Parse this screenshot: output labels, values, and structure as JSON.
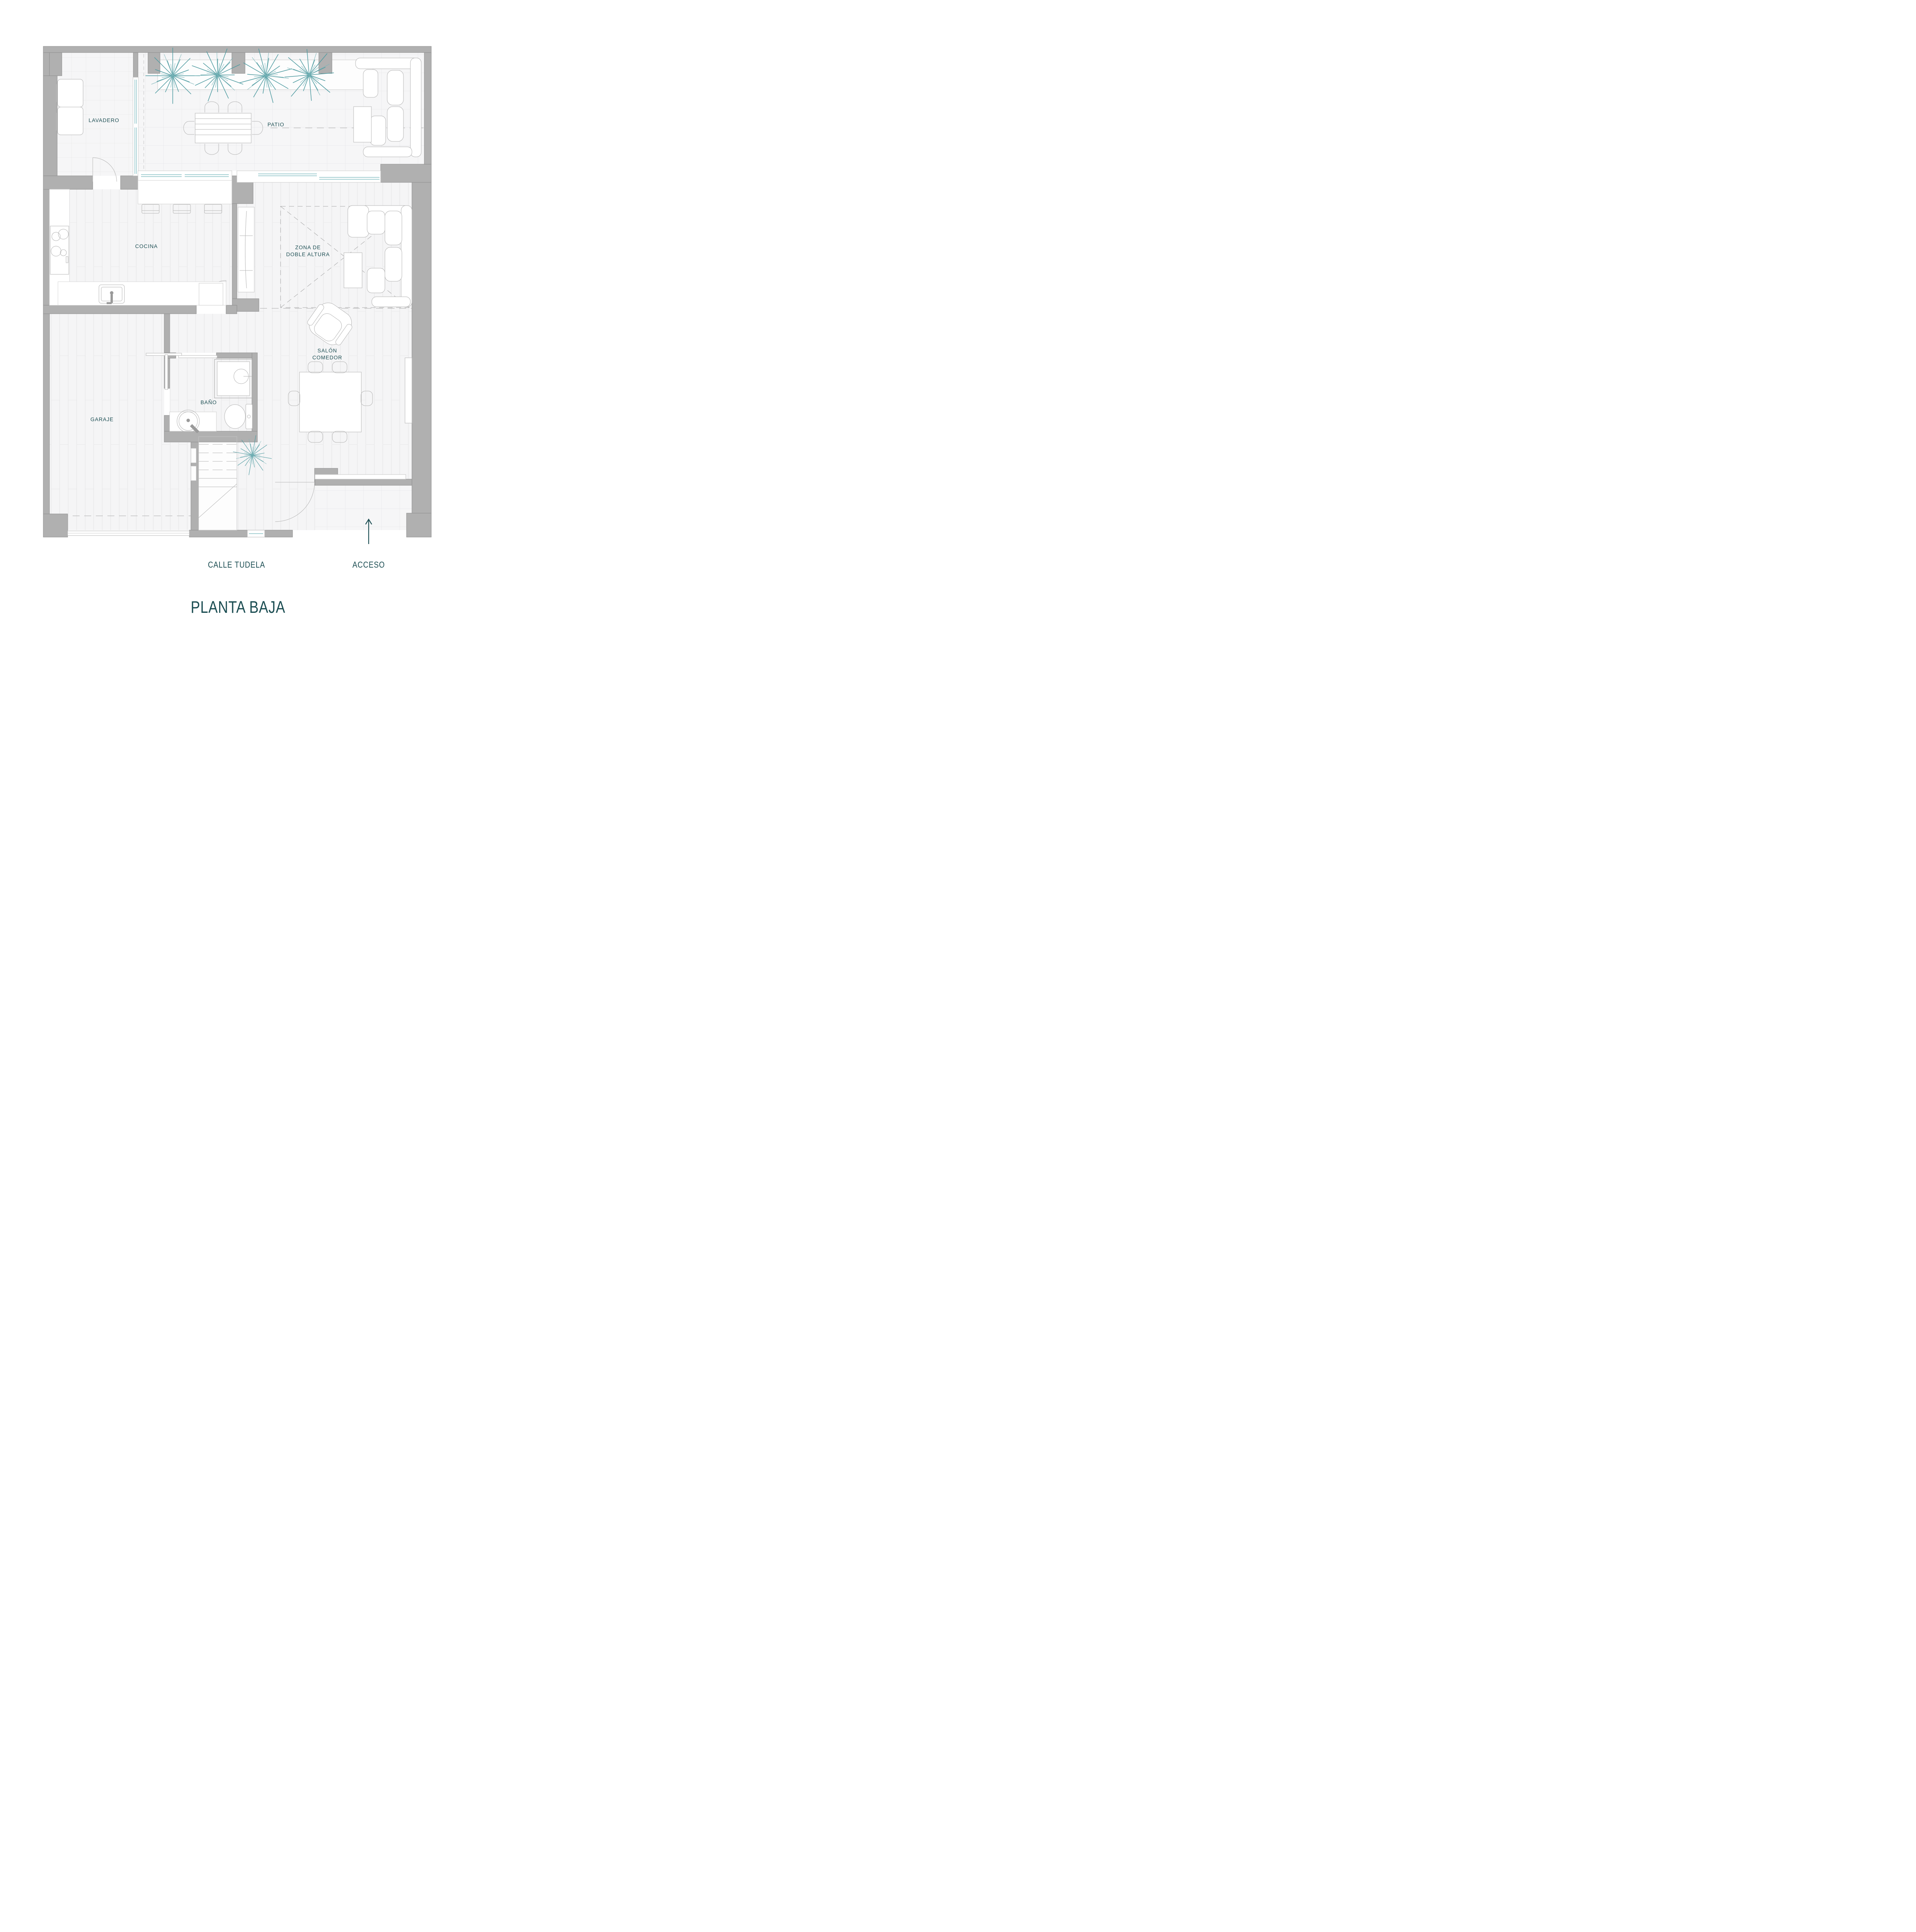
{
  "title": {
    "text": "PLANTA BAJA"
  },
  "street": {
    "label": "CALLE TUDELA"
  },
  "access": {
    "label": "ACCESO",
    "arrow_icon": "up-arrow"
  },
  "rooms": {
    "lavadero": "LAVADERO",
    "patio": "PATIO",
    "cocina": "COCINA",
    "zona_line1": "ZONA DE",
    "zona_line2": "DOBLE ALTURA",
    "salon_line1": "SALÓN",
    "salon_line2": "COMEDOR",
    "bano": "BAÑO",
    "garaje": "GARAJE"
  },
  "colors": {
    "wall_gray": "#b0b0b0",
    "wall_outline": "#8d8d8d",
    "label_teal": "#1b4d52",
    "plant_teal": "#4d9aa0",
    "glazing_teal": "#86bfc4",
    "floor_light": "#f5f5f6",
    "furniture_stroke": "#b3b3b3"
  }
}
